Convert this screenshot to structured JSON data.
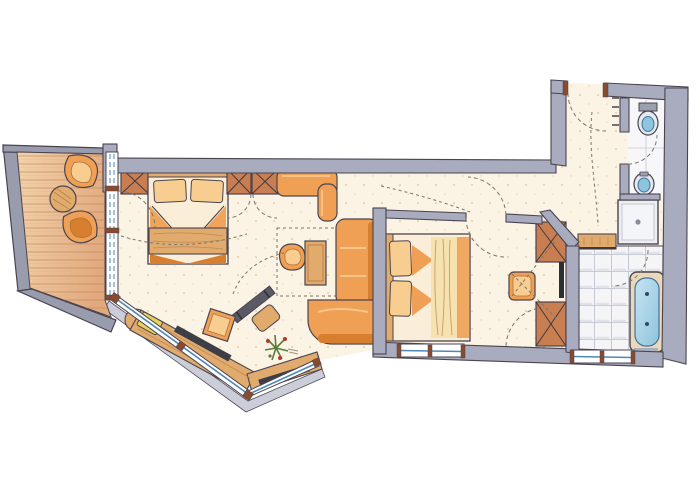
{
  "figure": {
    "type": "floor-plan",
    "title": "Hand-drawn watercolor floor plan of a hotel suite with balcony, two sleeping areas, living area and bathroom",
    "rooms": [
      {
        "id": "balcony",
        "label": "Balcony terrace",
        "items": [
          "lounge-chair",
          "round-side-table",
          "lounge-chair",
          "wood-deck",
          "parapet"
        ]
      },
      {
        "id": "sleeping-area-1",
        "label": "Sleeping area 1",
        "items": [
          "wardrobe",
          "double-bed",
          "wardrobe",
          "wardrobe",
          "blanket-chest"
        ]
      },
      {
        "id": "living-area",
        "label": "Living area",
        "items": [
          "wall-bench",
          "armchair",
          "side-table",
          "corner-sofa",
          "desk",
          "desk-chair",
          "window-bench",
          "radiator",
          "occasional-table",
          "plant"
        ]
      },
      {
        "id": "bedroom-2",
        "label": "Bedroom 2",
        "items": [
          "double-bed",
          "corner-wardrobe",
          "wardrobe",
          "stool",
          "dressing-mirror"
        ]
      },
      {
        "id": "bathroom",
        "label": "Bathroom",
        "items": [
          "vanity-counter",
          "bathtub",
          "tiled-floor"
        ]
      },
      {
        "id": "shower-room",
        "label": "Shower",
        "items": [
          "shower-tray",
          "drain"
        ]
      },
      {
        "id": "wc-room",
        "label": "WC",
        "items": [
          "toilet",
          "bidet"
        ]
      },
      {
        "id": "entrance-hall",
        "label": "Entrance hall",
        "items": [
          "entrance-door",
          "coat-hooks",
          "corridor"
        ]
      }
    ]
  },
  "palette": {
    "ink": "#4a4450",
    "wall": "#a9abbe",
    "parapet": "#999cad",
    "ledge": "#c9cbd8",
    "floor": "#fbf3e4",
    "dot": "#cf9254",
    "deck1": "#f3d2ab",
    "deck2": "#e2a97e",
    "plank": "#b5understood"
  },
  "palette_fix_note": "see palette2",
  "palette2": {
    "plank": "#b57f4e",
    "orange": "#efa055",
    "orangeDark": "#d77f2e",
    "woodLight": "#e2ab6e",
    "woodDark": "#a96f3a",
    "terracotta": "#c97e52",
    "cream": "#faeed8",
    "pillow": "#f8cd90",
    "duvet": "#f5e2ae",
    "tile": "#f5f5f8",
    "tileLine": "#c5c8d2",
    "water": "#8fc4dd",
    "waterDark": "#44729c",
    "glass": "#4f87b5",
    "jamb": "#8a4a2e",
    "dark": "#3e3a40",
    "plantGreen": "#5a7c3c",
    "plantRed": "#b03a2e",
    "yellow": "#e8d35a",
    "annotation": "#7a7668"
  }
}
